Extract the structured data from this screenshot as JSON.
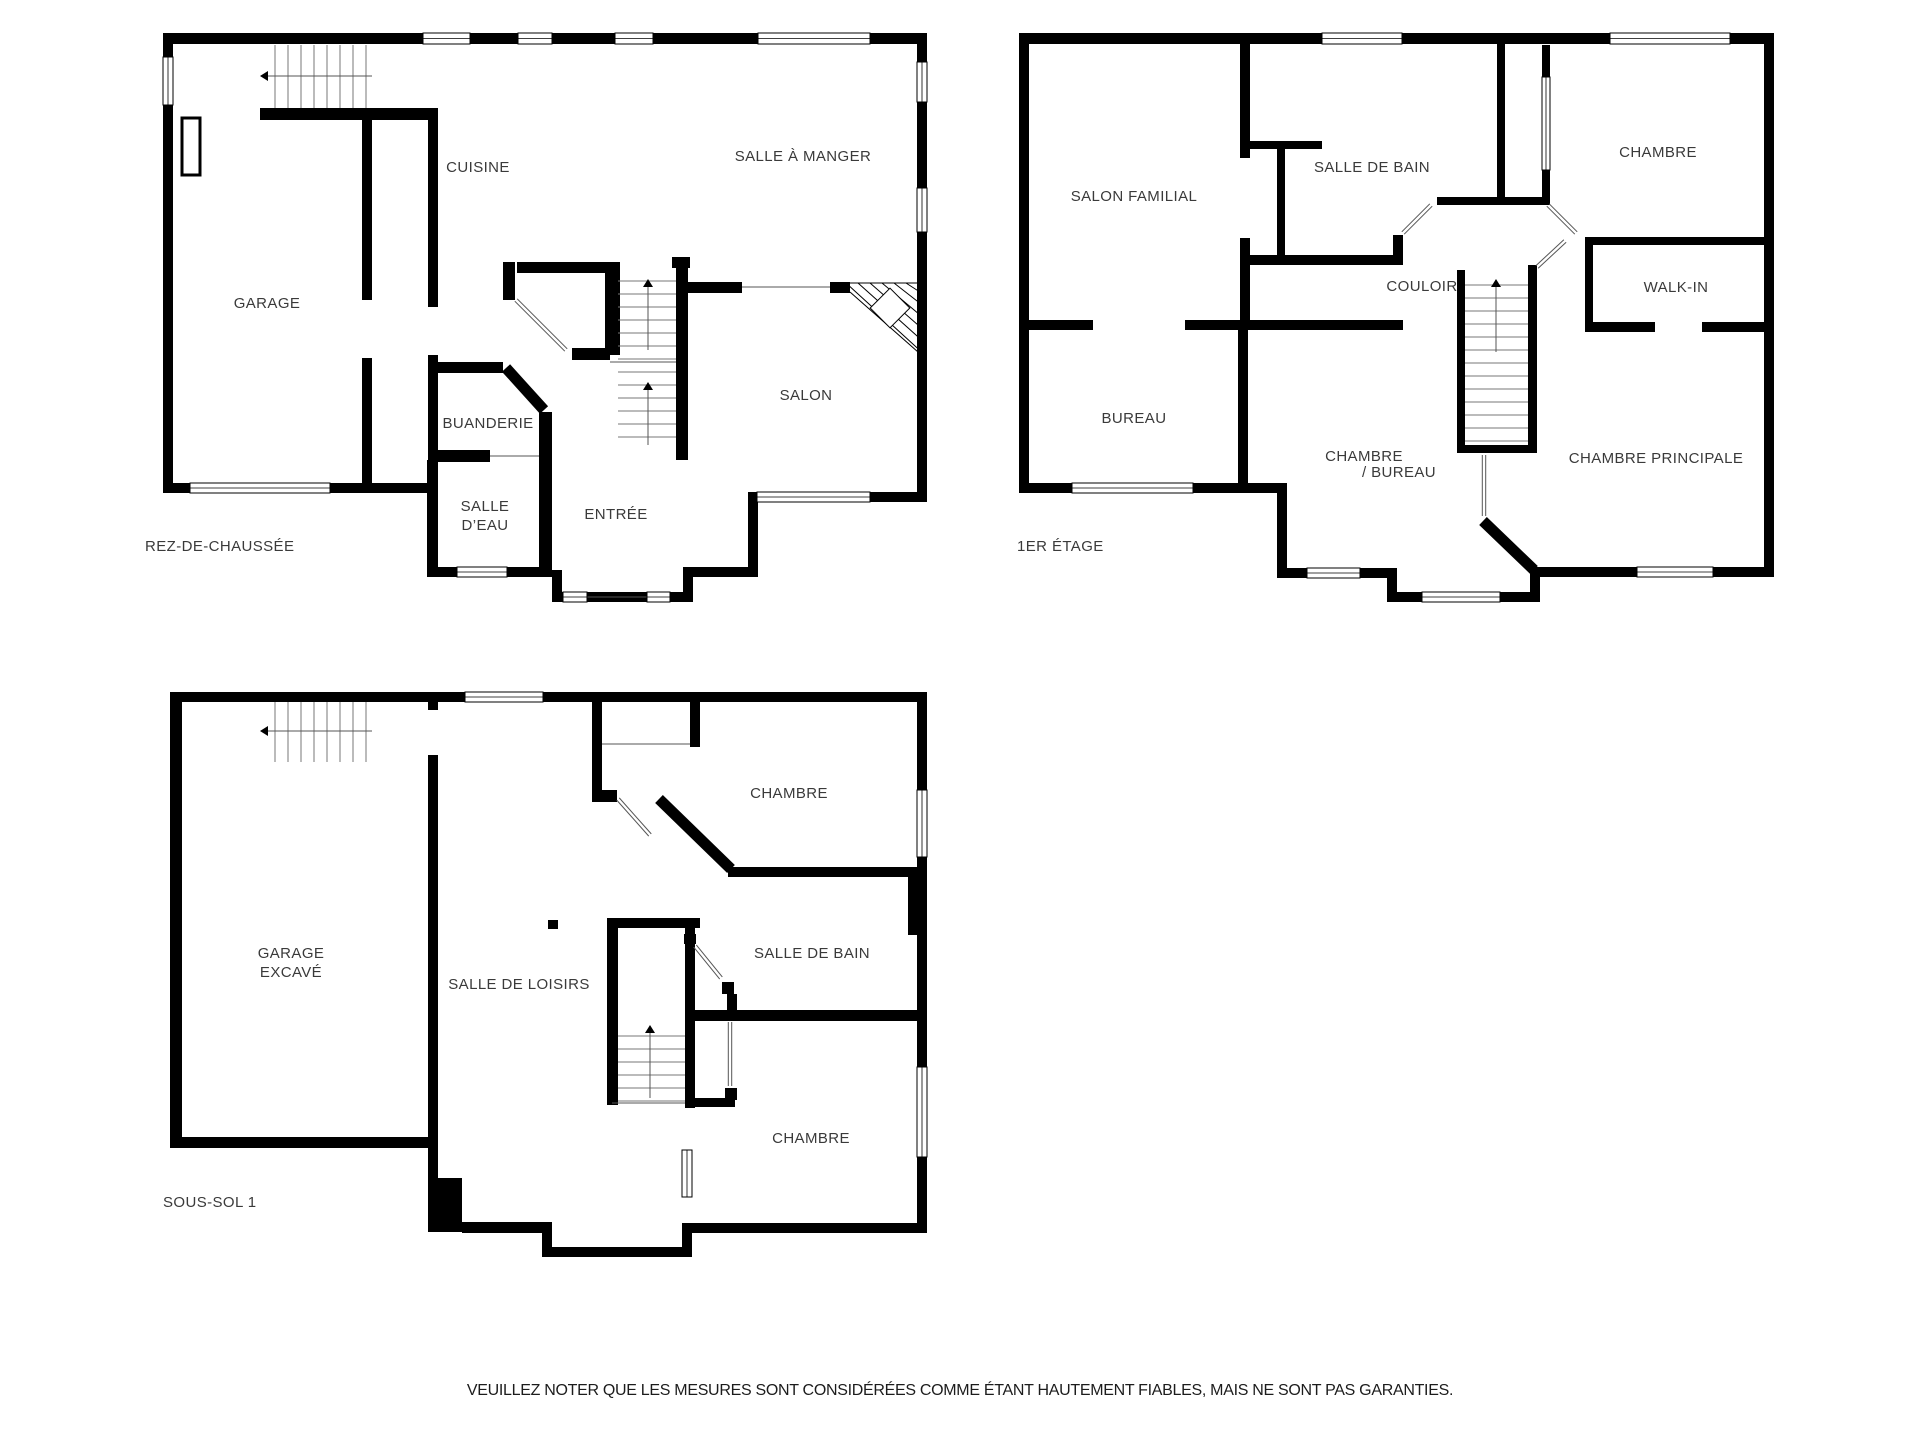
{
  "floors": {
    "ground": {
      "label": "REZ-DE-CHAUSSÉE",
      "rooms": {
        "garage": "GARAGE",
        "cuisine": "CUISINE",
        "salle_a_manger": "SALLE À MANGER",
        "buanderie": "BUANDERIE",
        "salle_deau_line1": "SALLE",
        "salle_deau_line2": "D’EAU",
        "entree": "ENTRÉE",
        "salon": "SALON"
      }
    },
    "first": {
      "label": "1ER ÉTAGE",
      "rooms": {
        "salon_familial": "SALON FAMILIAL",
        "salle_de_bain": "SALLE DE BAIN",
        "chambre": "CHAMBRE",
        "couloir": "COULOIR",
        "walk_in": "WALK-IN",
        "bureau": "BUREAU",
        "chambre_bureau_line1": "CHAMBRE",
        "chambre_bureau_line2": "/ BUREAU",
        "chambre_principale": "CHAMBRE PRINCIPALE"
      }
    },
    "basement": {
      "label": "SOUS-SOL 1",
      "rooms": {
        "garage_excave_line1": "GARAGE",
        "garage_excave_line2": "EXCAVÉ",
        "salle_de_loisirs": "SALLE DE LOISIRS",
        "chambre_haut": "CHAMBRE",
        "salle_de_bain": "SALLE DE BAIN",
        "chambre_bas": "CHAMBRE"
      }
    }
  },
  "disclaimer": "VEUILLEZ NOTER QUE LES MESURES SONT CONSIDÉRÉES COMME ÉTANT HAUTEMENT FIABLES, MAIS NE SONT PAS GARANTIES.",
  "colors": {
    "wall": "#000000",
    "label": "#3a3a3a",
    "background": "#ffffff",
    "disclaimer_text": "#1c1c1c"
  }
}
